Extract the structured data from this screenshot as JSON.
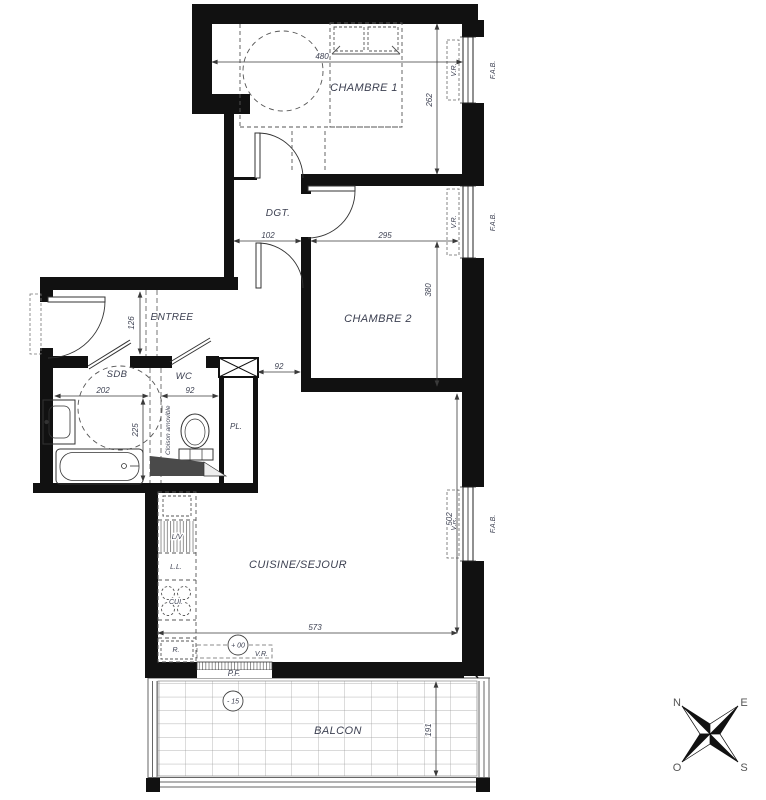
{
  "plan": {
    "rooms": {
      "chambre1": "CHAMBRE 1",
      "chambre2": "CHAMBRE 2",
      "dgt": "DGT.",
      "entree": "ENTREE",
      "sdb": "SDB",
      "wc": "WC",
      "placard": "PL.",
      "cuisine_sejour": "CUISINE/SEJOUR",
      "balcon": "BALCON"
    },
    "dimensions_cm": {
      "chambre1_w": "480",
      "chambre1_d": "262",
      "dgt_w": "102",
      "chambre2_w": "295",
      "chambre2_d": "380",
      "entree_w": "126",
      "sdb_w": "202",
      "sdb_d": "225",
      "wc_w": "92",
      "couloir_w": "92",
      "sejour_w": "573",
      "sejour_d": "502",
      "balcon_d": "191"
    },
    "levels": {
      "interieur": "+ 00",
      "balcon": "- 15"
    },
    "annotations": {
      "volet_roulant": "V.R.",
      "facade": "F.A.B.",
      "porte_fenetre": "P.F.",
      "cloison": "Cloison amovible",
      "lave_vaisselle": "L/V",
      "lave_linge": "L.L.",
      "cuisson": "CUI.",
      "refrigerateur": "R."
    },
    "compass": {
      "north": "N",
      "east": "E",
      "south": "S",
      "west": "O"
    },
    "colors": {
      "wall": "#111111",
      "label": "#3d4152",
      "grid": "#9a9a9a"
    }
  }
}
